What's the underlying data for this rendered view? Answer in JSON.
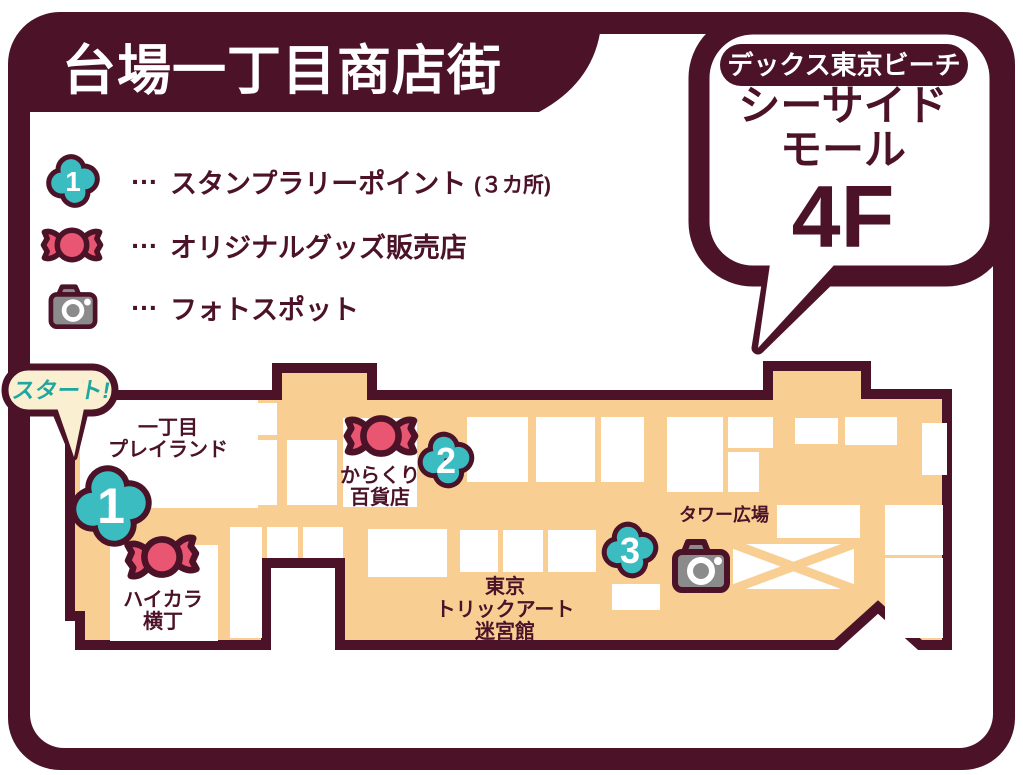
{
  "colors": {
    "maroon": "#4B1228",
    "orange": "#F8CE92",
    "teal_marker": "#3BBCC0",
    "teal_text": "#1EA79E",
    "pink_candy": "#E85672",
    "cream_bubble": "#FBEFD2",
    "camera_gray": "#8B8B8B",
    "white": "#FFFFFF"
  },
  "header": {
    "title": "台場一丁目商店街"
  },
  "location_bubble": {
    "badge": "デックス東京ビーチ",
    "name_line1": "シーサイド",
    "name_line2": "モール",
    "floor": "4F"
  },
  "legend": {
    "items": [
      {
        "marker_number": "1",
        "ellipsis": "…",
        "label": "スタンプラリーポイント",
        "note": "(３カ所)"
      },
      {
        "ellipsis": "…",
        "label": "オリジナルグッズ販売店"
      },
      {
        "ellipsis": "…",
        "label": "フォトスポット"
      }
    ]
  },
  "map": {
    "start_label": "スタート!",
    "stamp_points": [
      {
        "number": "1"
      },
      {
        "number": "2"
      },
      {
        "number": "3"
      }
    ],
    "areas": [
      {
        "id": "playland",
        "line1": "一丁目",
        "line2": "プレイランド"
      },
      {
        "id": "haikara",
        "line1": "ハイカラ",
        "line2": "横丁"
      },
      {
        "id": "karakuri",
        "line1": "からくり",
        "line2": "百貨店"
      },
      {
        "id": "trickart",
        "line1": "東京",
        "line2": "トリックアート",
        "line3": "迷宮館"
      },
      {
        "id": "tower",
        "line1": "タワー広場"
      }
    ]
  }
}
